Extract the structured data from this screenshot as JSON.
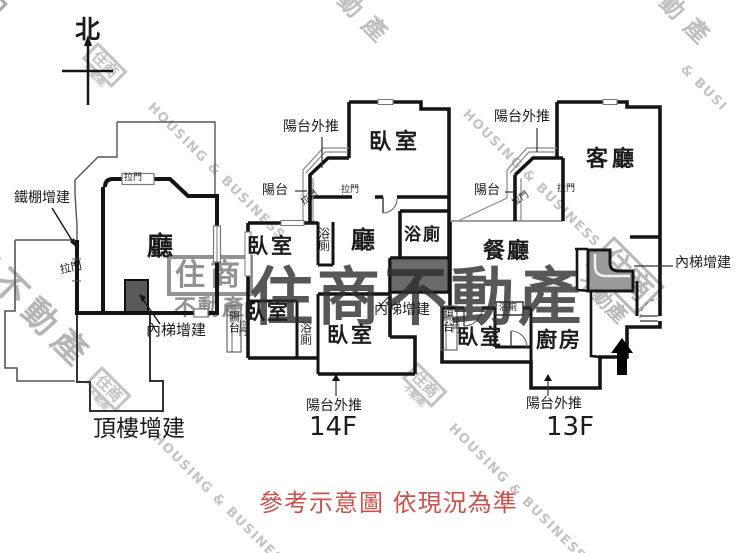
{
  "compass": {
    "north": "北"
  },
  "plans": {
    "rooftop": {
      "name": "頂樓增建",
      "hall": "廳",
      "iron_shed": "鐵棚增建",
      "inner_stairs": "內梯增建",
      "sliding_door_top": "拉門",
      "sliding_door_left": "拉門"
    },
    "f14": {
      "name": "14F",
      "bedroom_top": "臥室",
      "bedroom_upper_left": "臥室",
      "bedroom_lower_left": "臥室",
      "bedroom_center": "臥室",
      "hall": "廳",
      "bath_upper": "浴廁",
      "bath_right": "浴廁",
      "bath_lower": "浴廁",
      "balcony_top": "陽台",
      "balcony_strip": "陽台",
      "balcony_pushout_top": "陽台外推",
      "balcony_pushout_bottom": "陽台外推",
      "inner_stairs": "內梯增建",
      "sliding_door_1": "拉門",
      "sliding_door_2": "拉門",
      "sliding_door_strip": "拉門"
    },
    "f13": {
      "name": "13F",
      "living": "客廳",
      "dining": "餐廳",
      "kitchen": "廚房",
      "bedroom": "臥室",
      "bath": "浴廁",
      "balcony_top": "陽台",
      "balcony_strip": "陽台",
      "balcony_pushout_top": "陽台外推",
      "balcony_pushout_bottom": "陽台外推",
      "inner_stairs": "內梯增建",
      "sliding_door_1": "拉門",
      "sliding_door_2": "拉門",
      "sliding_door_strip": "拉門"
    }
  },
  "watermarks": {
    "brand_box": "住商",
    "brand_sub": "不動產",
    "brand_full": "住商不動產",
    "frag_top": "動產",
    "frag_left": "商不動產",
    "housing_business": "HOUSING & BUSINESS",
    "hb_fragment": "& BUSI"
  },
  "footer": {
    "disclaimer": "參考示意圖 依現況為準",
    "color": "#c9524e"
  },
  "colors": {
    "wall": "#141414",
    "stairs_fill": "#6a6a6a",
    "watermark_dark": "rgba(45,45,45,0.8)",
    "watermark_light": "#c3c3c3"
  }
}
